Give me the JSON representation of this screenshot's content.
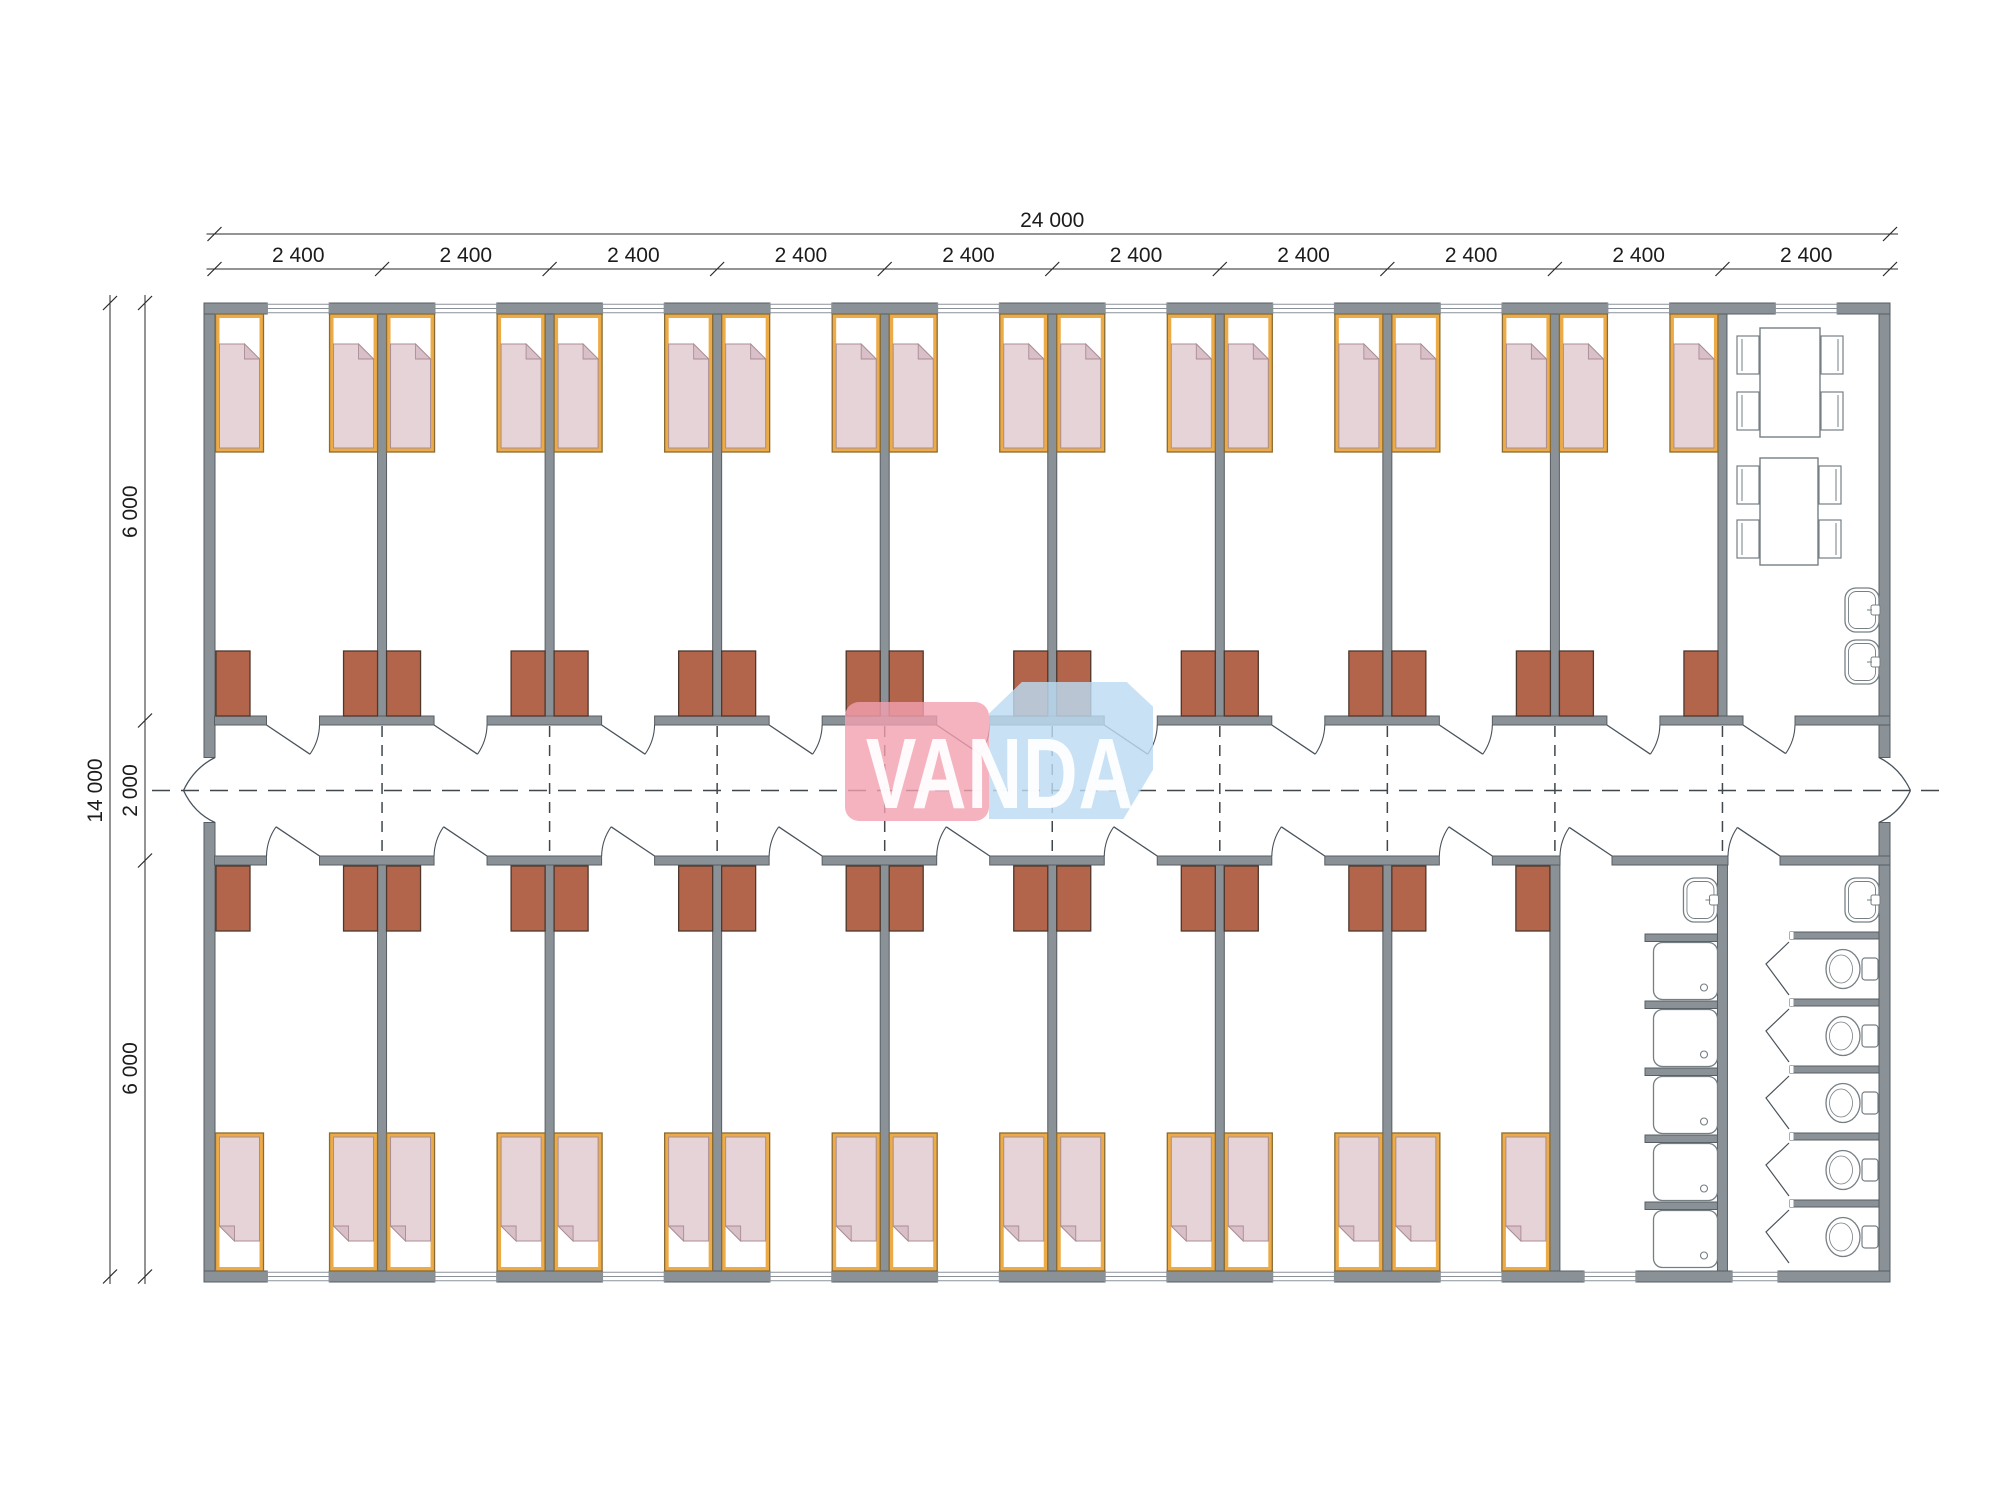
{
  "watermark": {
    "text": "VANDA",
    "pink": "#f2a0b0",
    "blue": "#bcdaf2"
  },
  "dimensions": {
    "top_total": "24 000",
    "top_modules": [
      "2 400",
      "2 400",
      "2 400",
      "2 400",
      "2 400",
      "2 400",
      "2 400",
      "2 400",
      "2 400",
      "2 400"
    ],
    "left_total": "14 000",
    "left_segments": [
      "6 000",
      "2 000",
      "6 000"
    ]
  },
  "plan": {
    "colors": {
      "wall": "#8a9298",
      "wall_edge": "#575f64",
      "bed_frame": "#edab47",
      "bed_edge": "#8a6b33",
      "blanket": "#e6d3d8",
      "blanket_edge": "#a98d94",
      "blanket_flap": "#d9bfc7",
      "wardrobe": "#b2654b",
      "wardrobe_edge": "#4e372c",
      "fixture_line": "#767f84",
      "door_line": "#49525a",
      "dash_line": "#3f474c",
      "dim_line": "#2a2a2a",
      "dim_text": "#1c1c1c"
    },
    "counts": {
      "beds": 34,
      "wardrobes": 34,
      "room_doors": 20,
      "entrance_double_doors": 2,
      "windows": 20,
      "dining_tables": 2,
      "chairs": 8,
      "wash_basins": 4,
      "shower_trays": 5,
      "toilets": 5,
      "toilet_stalls": 5
    }
  }
}
